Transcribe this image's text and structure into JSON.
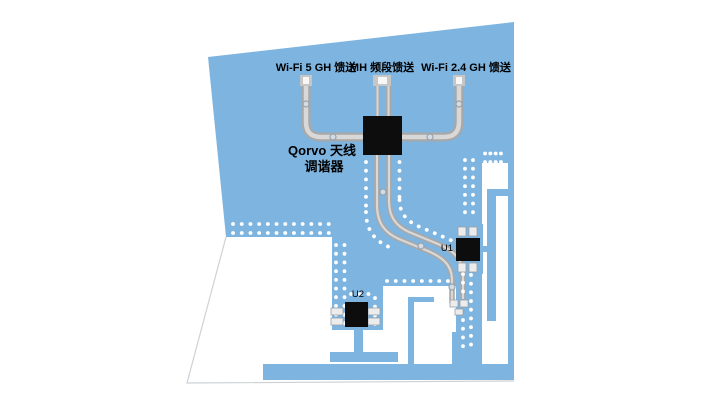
{
  "diagram": {
    "type": "pcb-antenna-layout",
    "feeds": [
      {
        "label": "Wi-Fi 5 GH 馈送"
      },
      {
        "label": "MH 频段馈送"
      },
      {
        "label": "Wi-Fi 2.4 GH 馈送"
      }
    ],
    "tuner_chip": {
      "label_line1": "Qorvo 天线",
      "label_line2": "调谐器"
    },
    "components": [
      {
        "ref": "U1"
      },
      {
        "ref": "U2"
      }
    ],
    "colors": {
      "pcb_copper_blue": "#7db4e0",
      "trace_edge_gray": "#a8a8a8",
      "trace_fill_gray": "#d8d8d8",
      "chip_black": "#0d0d0d",
      "via_white": "#ffffff",
      "board_edge_gray": "#cdd2d6",
      "background": "#ffffff"
    }
  }
}
